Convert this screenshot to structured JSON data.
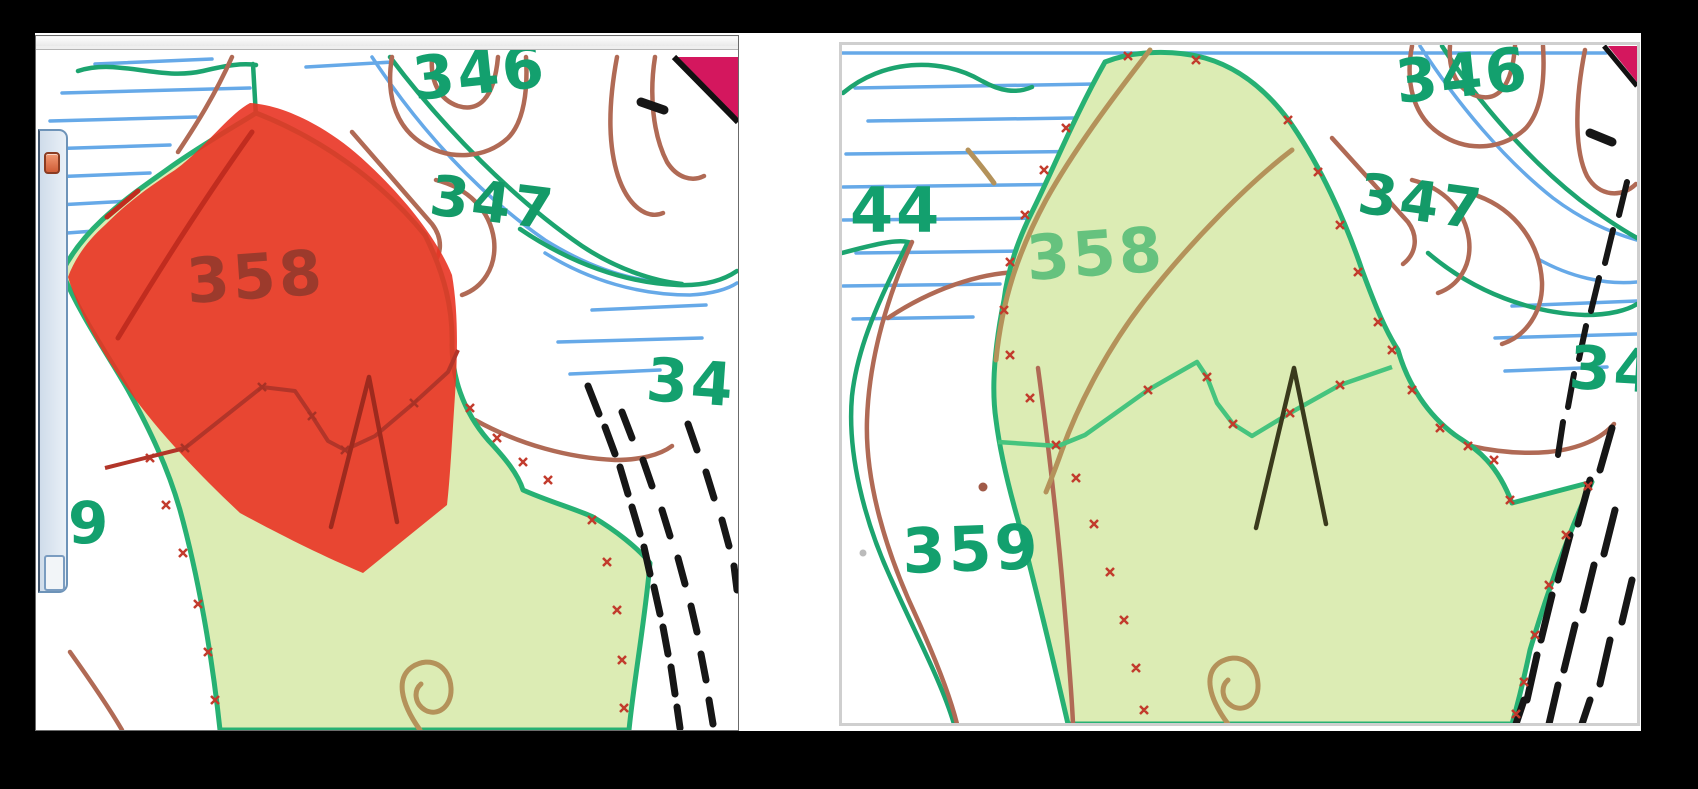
{
  "scene": {
    "description": "Side-by-side comparison of two digitized forestry map views; left view shows stand 358 highlighted with a semi-transparent red selection polygon, right view shows the same digitized stand without selection.",
    "background_color": "#000000",
    "page_color": "#ffffff"
  },
  "left_map": {
    "highlighted_stand": "358",
    "selection_color": "#e93424",
    "labels": {
      "stand_346": "346",
      "stand_347": "347",
      "stand_349_partial": "34",
      "stand_358": "358",
      "stand_359_partial": "9"
    }
  },
  "right_map": {
    "labels": {
      "stand_344_partial": "44",
      "stand_346": "346",
      "stand_347": "347",
      "stand_349_partial": "34",
      "stand_358": "358",
      "stand_359": "359"
    }
  },
  "palette": {
    "map_green_line": "#1ca46f",
    "stand_fill": "#dcecb4",
    "wetland_blue": "#66a9e8",
    "contour_brown": "#b06a55",
    "path_tan": "#b4925a",
    "label_green": "#13a06e",
    "label_light_green": "#66c27e",
    "selection_red": "#e93424",
    "marker_x_red": "#c23b2c",
    "hatch_black": "#161616",
    "road_magenta": "#d4175e"
  }
}
